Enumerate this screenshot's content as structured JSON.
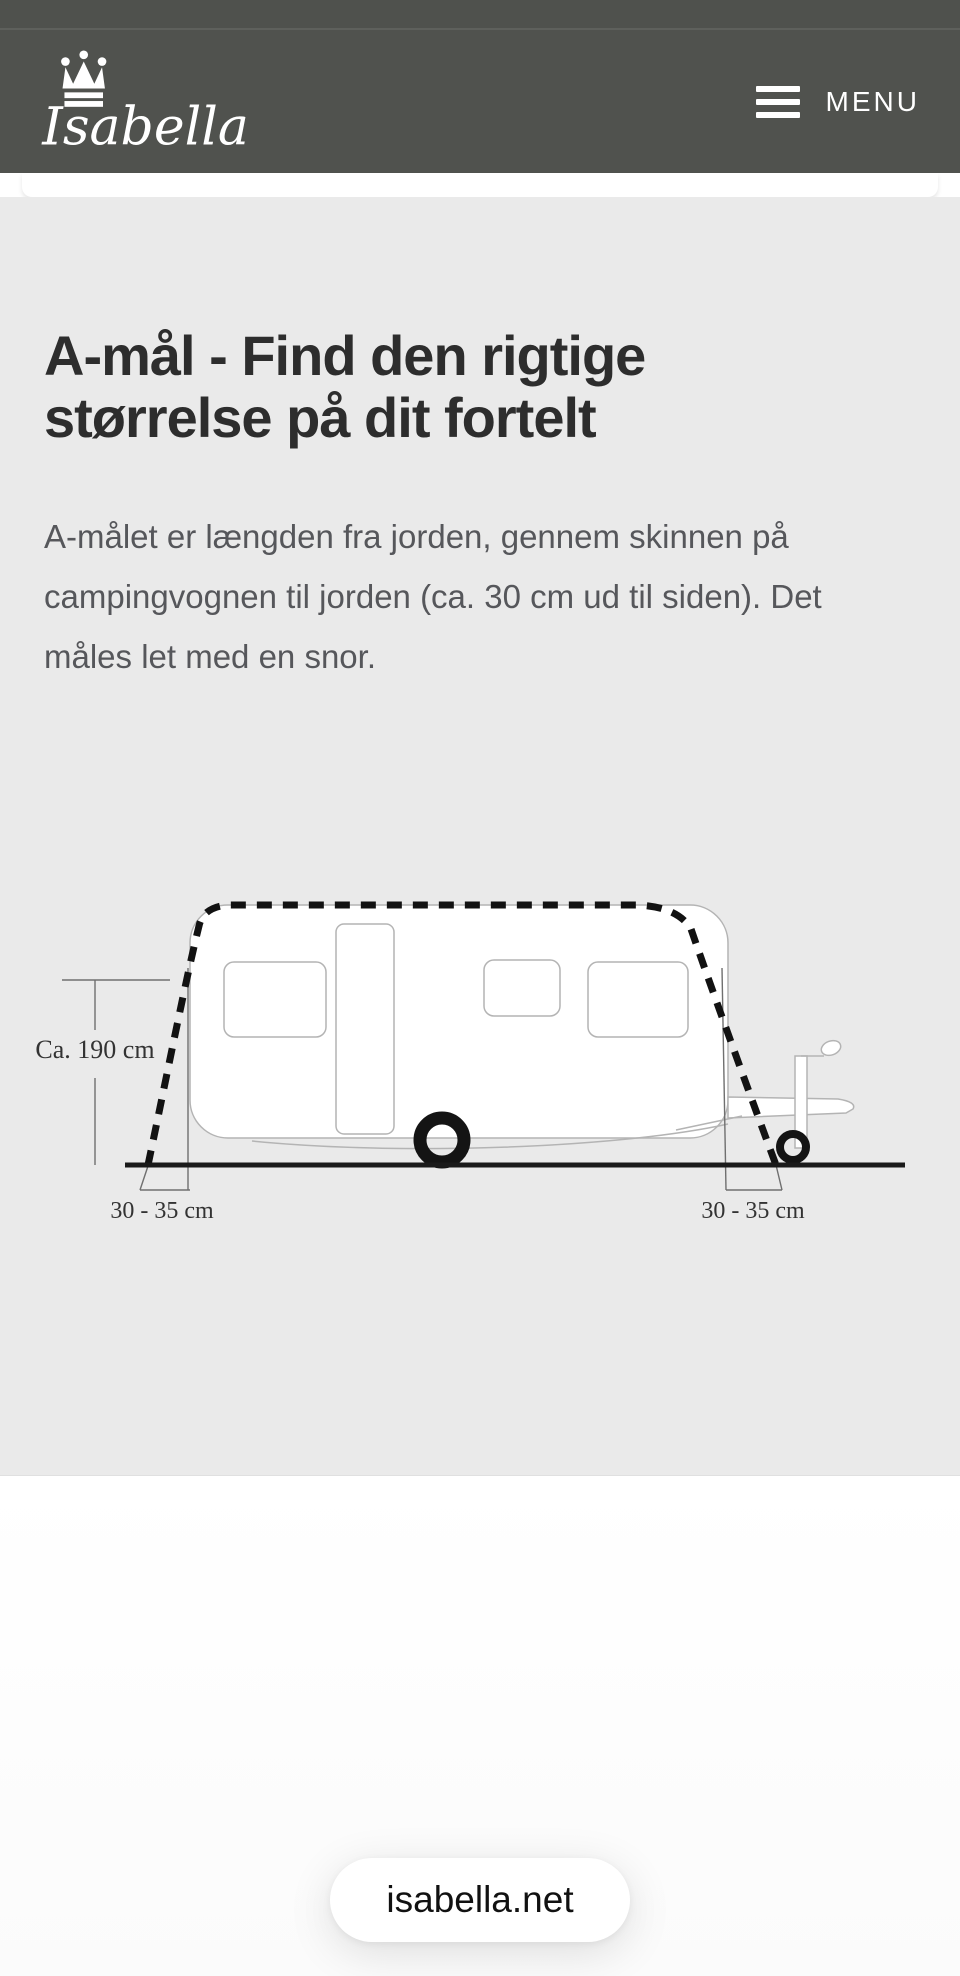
{
  "header": {
    "brand": "Isabella",
    "menu_label": "MENU"
  },
  "content": {
    "heading_line1": "A-mål - Find den rigtige",
    "heading_line2": "størrelse på dit fortelt",
    "paragraph": "A-målet er længden fra jorden, gennem skinnen på campingvognen til jorden (ca. 30 cm ud til siden). Det måles let med en snor."
  },
  "diagram": {
    "label_height": "Ca. 190 cm",
    "label_left": "30 - 35 cm",
    "label_right": "30 - 35 cm"
  },
  "browser": {
    "url_pill": "isabella.net"
  },
  "colors": {
    "header_bg": "#50524e",
    "section_bg": "#eaeaea",
    "heading_text": "#2d2d2d",
    "body_text": "#56575b",
    "diagram_line": "#141414",
    "caravan_outline": "#b4b4b4"
  }
}
